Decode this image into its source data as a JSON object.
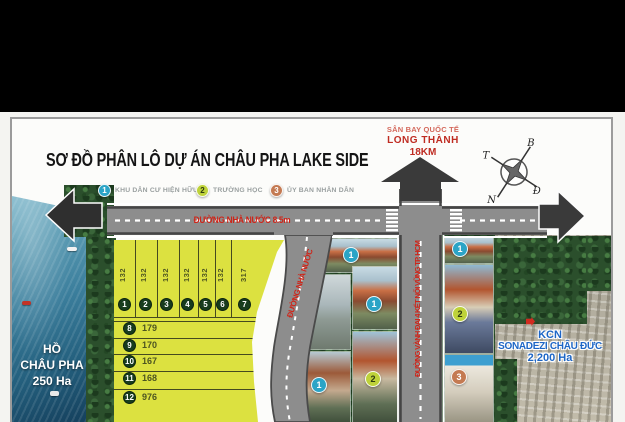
{
  "title": "SƠ ĐỒ PHÂN LÔ DỰ ÁN  CHÂU PHA LAKE SIDE",
  "legend": {
    "items": [
      {
        "num": "1",
        "label": "KHU DÂN CƯ HIỆN HỮU"
      },
      {
        "num": "2",
        "label": "TRƯỜNG HỌC"
      },
      {
        "num": "3",
        "label": "ỦY BAN NHÂN DÂN"
      }
    ]
  },
  "airport": {
    "line1": "SÂN BAY QUỐC TẾ",
    "line2": "LONG THÀNH",
    "line3": "18KM"
  },
  "compass": {
    "n": "B",
    "w": "T",
    "e": "Đ",
    "s": "N"
  },
  "roads": {
    "main_label": "ĐƯỜNG NHÀ NƯỚC 8.5m",
    "branch_label": "ĐƯỜNG NHÀ NƯỚC",
    "ring_label": "ĐƯỜNG VÀNH ĐAI 4 KẾT NỐI VŨNG TP. HCM"
  },
  "lake": {
    "line1": "HỒ",
    "line2": "CHÂU PHA",
    "line3": "250 Ha"
  },
  "industrial_zone": {
    "line1": "KCN",
    "line2": "SONADEZI CHÂU ĐỨC",
    "line3": "2,200 Ha"
  },
  "lots": {
    "vertical": [
      {
        "no": "1",
        "area": "132"
      },
      {
        "no": "2",
        "area": "132"
      },
      {
        "no": "3",
        "area": "132"
      },
      {
        "no": "4",
        "area": "132"
      },
      {
        "no": "5",
        "area": "132"
      },
      {
        "no": "6",
        "area": "132"
      },
      {
        "no": "7",
        "area": "317"
      }
    ],
    "horizontal": [
      {
        "no": "8",
        "area": "179"
      },
      {
        "no": "9",
        "area": "170"
      },
      {
        "no": "10",
        "area": "167"
      },
      {
        "no": "11",
        "area": "168"
      },
      {
        "no": "12",
        "area": "976"
      }
    ]
  },
  "map_markers": {
    "residential": [
      {
        "num": "1"
      },
      {
        "num": "1"
      },
      {
        "num": "1"
      },
      {
        "num": "1"
      }
    ],
    "school": [
      {
        "num": "2"
      },
      {
        "num": "2"
      }
    ],
    "committee": [
      {
        "num": "3"
      }
    ]
  },
  "colors": {
    "residential_marker": "#2ba4c6",
    "school_marker": "#bed23a",
    "committee_marker": "#c4774e",
    "lot_fill": "#dce140",
    "road_label_red": "#cf2418",
    "kcn_blue": "#1d66c6"
  }
}
